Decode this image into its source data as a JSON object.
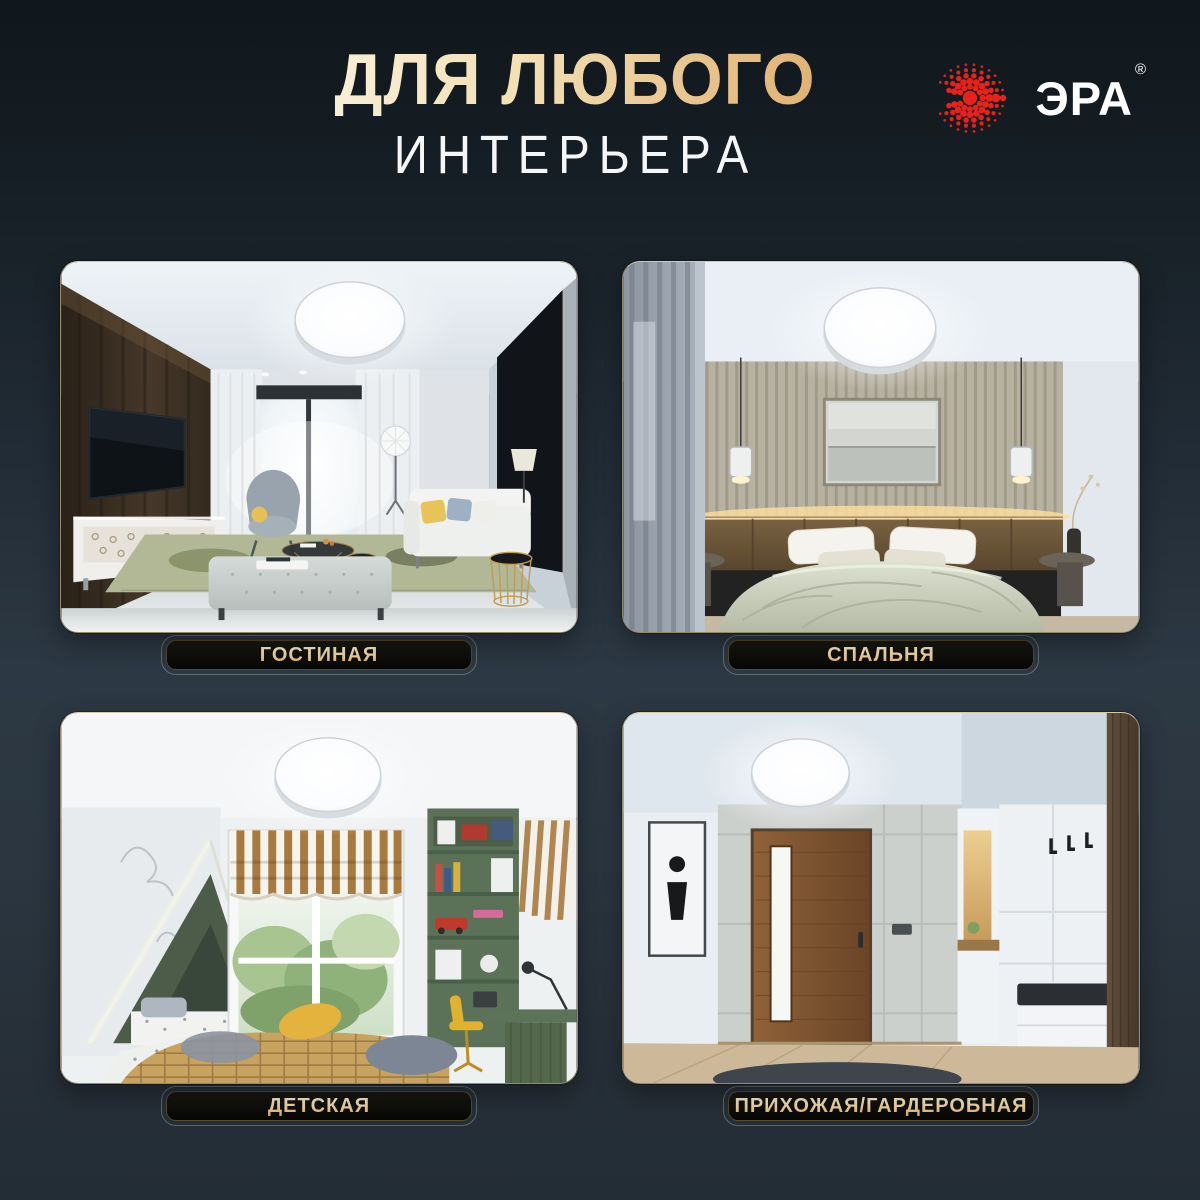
{
  "page": {
    "background_top": "#10171d",
    "background_middle": "#2c3843",
    "background_bottom": "#232d35",
    "accent_gold": "#e0b173"
  },
  "header": {
    "title_line1": "ДЛЯ ЛЮБОГО",
    "title_line2": "ИНТЕРЬЕРА"
  },
  "brand": {
    "name": "ЭРА",
    "registered": "®",
    "logo_red": "#e8221b",
    "text_color": "#ffffff"
  },
  "cards": [
    {
      "label": "ГОСТИНАЯ",
      "scene": "living-room"
    },
    {
      "label": "СПАЛЬНЯ",
      "scene": "bedroom"
    },
    {
      "label": "ДЕТСКАЯ",
      "scene": "kids-room"
    },
    {
      "label": "ПРИХОЖАЯ/ГАРДЕРОБНАЯ",
      "scene": "hallway-wardrobe"
    }
  ],
  "label_style": {
    "text_gradient_top": "#faf1d4",
    "text_gradient_bottom": "#d1964a",
    "plate_background": "#0c0c09"
  }
}
